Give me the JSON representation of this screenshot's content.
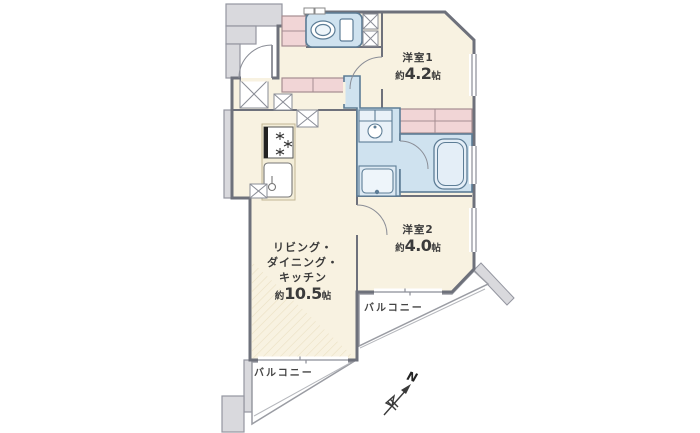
{
  "floorplan": {
    "rooms": [
      {
        "id": "room1",
        "name_label": "洋室1",
        "size_prefix": "約",
        "size_value": "4.2",
        "size_unit": "帖"
      },
      {
        "id": "room2",
        "name_label": "洋室2",
        "size_prefix": "約",
        "size_value": "4.0",
        "size_unit": "帖"
      },
      {
        "id": "ldk",
        "name_lines": [
          "リビング・",
          "ダイニング・",
          "キッチン"
        ],
        "size_prefix": "約",
        "size_value": "10.5",
        "size_unit": "帖"
      }
    ],
    "balconies": [
      {
        "id": "balcony-bottom",
        "label": "バルコニー"
      },
      {
        "id": "balcony-right",
        "label": "バルコニー"
      }
    ],
    "compass": {
      "label": "N"
    },
    "colors": {
      "room_floor": "#f8f2e1",
      "wet_area": "#cfe2ef",
      "closet_pink": "#f1d5d6",
      "wall_gray": "#6e717b",
      "common_area_gray": "#d9d9dd",
      "fixture_line_blue": "#5d7d96",
      "balcony_line": "#9a9ca3",
      "background": "#ffffff"
    },
    "fixture_icons": [
      "toilet-icon",
      "washbasin-icon",
      "washing-machine-icon",
      "bathtub-icon",
      "stove-icon",
      "kitchen-sink-icon",
      "door-swing-icon",
      "pipe-shaft-icon",
      "meter-box-icon",
      "closet-icon",
      "window-icon",
      "compass-icon"
    ]
  }
}
